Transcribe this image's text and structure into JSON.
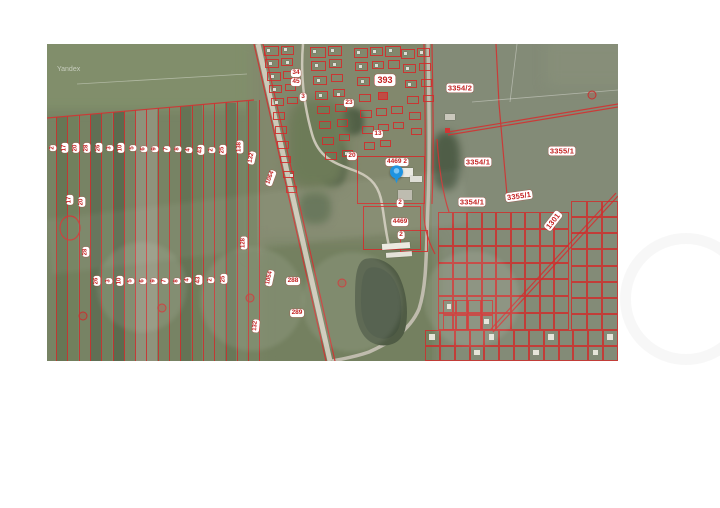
{
  "watermark": {
    "provider": "Yandex"
  },
  "map": {
    "x": 47,
    "y": 44,
    "w": 571,
    "h": 317,
    "base_color": "#717e5e",
    "accent_red": "#cf2b2b",
    "pin": {
      "x": 350,
      "y": 139,
      "color": "#1e93e0"
    },
    "strips": {
      "x0": 9,
      "spacing": 11.3,
      "count": 19,
      "top_left": 74,
      "top_right": 56,
      "bottom": 317
    },
    "strip_fills": [
      {
        "x": 9,
        "c": "#5d6d4c"
      },
      {
        "x": 20,
        "c": "#6a7a56"
      },
      {
        "x": 43,
        "c": "#55654a"
      },
      {
        "x": 54,
        "c": "#697957"
      },
      {
        "x": 66,
        "c": "#4f6044"
      },
      {
        "x": 88,
        "c": "#8e907a"
      },
      {
        "x": 99,
        "c": "#8f927c"
      },
      {
        "x": 133,
        "c": "#5a6a4c"
      },
      {
        "x": 144,
        "c": "#687854"
      },
      {
        "x": 178,
        "c": "#5f6f50"
      },
      {
        "x": 199,
        "c": "#6d7d5a"
      }
    ],
    "patches": [
      {
        "x": -10,
        "y": -12,
        "w": 245,
        "h": 78,
        "c": "#7c8a66",
        "blur": 5,
        "rad": 0
      },
      {
        "x": 205,
        "y": -6,
        "w": 190,
        "h": 215,
        "c": "#7d8368",
        "blur": 7,
        "rad": 0
      },
      {
        "x": 385,
        "y": -6,
        "w": 200,
        "h": 335,
        "c": "#7e8672",
        "blur": 0,
        "rad": 0
      },
      {
        "x": 500,
        "y": -4,
        "w": 85,
        "h": 45,
        "c": "#828a74",
        "blur": 6,
        "rad": 0
      },
      {
        "x": 215,
        "y": 196,
        "w": 175,
        "h": 130,
        "c": "#6e7b5a",
        "blur": 6,
        "rad": 0
      },
      {
        "x": 273,
        "y": 96,
        "w": 26,
        "h": 46,
        "c": "#41503c",
        "blur": 3,
        "rad": 40
      },
      {
        "x": 293,
        "y": 64,
        "w": 24,
        "h": 27,
        "c": "#49583f",
        "blur": 3,
        "rad": 40
      },
      {
        "x": 385,
        "y": 88,
        "w": 28,
        "h": 58,
        "c": "#475640",
        "blur": 4,
        "rad": 40
      },
      {
        "x": 252,
        "y": 148,
        "w": 32,
        "h": 32,
        "c": "#5b6b4d",
        "blur": 4,
        "rad": 40
      },
      {
        "x": 240,
        "y": 55,
        "w": 60,
        "h": 90,
        "c": "#677552",
        "blur": 6,
        "rad": 30
      }
    ],
    "labels": [
      {
        "t": "2",
        "x": 6,
        "y": 104,
        "r": -90
      },
      {
        "t": "17",
        "x": 18,
        "y": 104,
        "r": -90
      },
      {
        "t": "20",
        "x": 29,
        "y": 104,
        "r": -90
      },
      {
        "t": "28",
        "x": 40,
        "y": 104,
        "r": -90
      },
      {
        "t": "26",
        "x": 52,
        "y": 104,
        "r": -90
      },
      {
        "t": "3",
        "x": 63,
        "y": 104,
        "r": -90
      },
      {
        "t": "10",
        "x": 74,
        "y": 104,
        "r": -90
      },
      {
        "t": "5",
        "x": 86,
        "y": 104,
        "r": -90
      },
      {
        "t": "6",
        "x": 97,
        "y": 105,
        "r": -90
      },
      {
        "t": "9",
        "x": 108,
        "y": 105,
        "r": -90
      },
      {
        "t": "7",
        "x": 120,
        "y": 105,
        "r": -90
      },
      {
        "t": "8",
        "x": 131,
        "y": 105,
        "r": -90
      },
      {
        "t": "4",
        "x": 142,
        "y": 106,
        "r": -90
      },
      {
        "t": "43",
        "x": 154,
        "y": 106,
        "r": -90
      },
      {
        "t": "2",
        "x": 165,
        "y": 106,
        "r": -90
      },
      {
        "t": "25",
        "x": 176,
        "y": 106,
        "r": -90
      },
      {
        "t": "138",
        "x": 193,
        "y": 103,
        "r": -90
      },
      {
        "t": "132",
        "x": 205,
        "y": 114,
        "r": -78
      },
      {
        "t": "1064",
        "x": 224,
        "y": 134,
        "r": -70
      },
      {
        "t": "26",
        "x": 50,
        "y": 237,
        "r": -90
      },
      {
        "t": "3",
        "x": 62,
        "y": 237,
        "r": -90
      },
      {
        "t": "10",
        "x": 73,
        "y": 237,
        "r": -90
      },
      {
        "t": "5",
        "x": 84,
        "y": 237,
        "r": -90
      },
      {
        "t": "6",
        "x": 96,
        "y": 237,
        "r": -90
      },
      {
        "t": "9",
        "x": 107,
        "y": 237,
        "r": -90
      },
      {
        "t": "7",
        "x": 118,
        "y": 237,
        "r": -90
      },
      {
        "t": "8",
        "x": 130,
        "y": 237,
        "r": -90
      },
      {
        "t": "4",
        "x": 141,
        "y": 236,
        "r": -90
      },
      {
        "t": "43",
        "x": 152,
        "y": 236,
        "r": -90
      },
      {
        "t": "2",
        "x": 164,
        "y": 236,
        "r": -90
      },
      {
        "t": "25",
        "x": 177,
        "y": 235,
        "r": -90
      },
      {
        "t": "128",
        "x": 197,
        "y": 199,
        "r": -90
      },
      {
        "t": "1054",
        "x": 223,
        "y": 234,
        "r": -78
      },
      {
        "t": "132",
        "x": 209,
        "y": 282,
        "r": -85
      },
      {
        "t": "17",
        "x": 23,
        "y": 156,
        "r": -90
      },
      {
        "t": "20",
        "x": 35,
        "y": 158,
        "r": -90
      },
      {
        "t": "28",
        "x": 39,
        "y": 208,
        "r": -90
      },
      {
        "t": "34",
        "x": 249,
        "y": 29,
        "s": "m"
      },
      {
        "t": "45",
        "x": 249,
        "y": 38,
        "s": "m"
      },
      {
        "t": "3",
        "x": 256,
        "y": 53,
        "s": "m"
      },
      {
        "t": "23",
        "x": 302,
        "y": 59,
        "s": "m"
      },
      {
        "t": "393",
        "x": 338,
        "y": 36,
        "s": "xl"
      },
      {
        "t": "13",
        "x": 331,
        "y": 90,
        "s": "m"
      },
      {
        "t": "20",
        "x": 305,
        "y": 112,
        "s": "m"
      },
      {
        "t": "4469 2",
        "x": 350,
        "y": 118,
        "s": "m"
      },
      {
        "t": "2",
        "x": 353,
        "y": 159,
        "s": "m"
      },
      {
        "t": "4469",
        "x": 353,
        "y": 178,
        "s": "m"
      },
      {
        "t": "2",
        "x": 354,
        "y": 191,
        "s": "m"
      },
      {
        "t": "288",
        "x": 246,
        "y": 237,
        "s": "m"
      },
      {
        "t": "289",
        "x": 250,
        "y": 269,
        "s": "m"
      },
      {
        "t": "3354/2",
        "x": 413,
        "y": 44,
        "s": "l"
      },
      {
        "t": "3354/1",
        "x": 431,
        "y": 118,
        "s": "l"
      },
      {
        "t": "3354/1",
        "x": 425,
        "y": 158,
        "s": "l"
      },
      {
        "t": "3355/1",
        "x": 515,
        "y": 107,
        "s": "l"
      },
      {
        "t": "3355/1",
        "x": 472,
        "y": 152,
        "r": -8,
        "s": "l"
      },
      {
        "t": "1301",
        "x": 506,
        "y": 177,
        "r": -52,
        "s": "l"
      }
    ],
    "parcels": [
      [
        217,
        2,
        15,
        10
      ],
      [
        234,
        2,
        13,
        9
      ],
      [
        218,
        15,
        14,
        9
      ],
      [
        234,
        14,
        12,
        8
      ],
      [
        220,
        28,
        14,
        9
      ],
      [
        236,
        27,
        12,
        8
      ],
      [
        222,
        41,
        13,
        8
      ],
      [
        238,
        40,
        11,
        7
      ],
      [
        224,
        54,
        13,
        8
      ],
      [
        240,
        53,
        11,
        7
      ],
      [
        226,
        68,
        12,
        8
      ],
      [
        228,
        82,
        12,
        8
      ],
      [
        230,
        97,
        12,
        8
      ],
      [
        233,
        112,
        11,
        7
      ],
      [
        236,
        127,
        11,
        7
      ],
      [
        239,
        142,
        11,
        7
      ],
      [
        263,
        3,
        16,
        11
      ],
      [
        281,
        2,
        14,
        10
      ],
      [
        264,
        17,
        15,
        10
      ],
      [
        282,
        15,
        13,
        9
      ],
      [
        266,
        32,
        14,
        9
      ],
      [
        284,
        30,
        12,
        8
      ],
      [
        268,
        47,
        13,
        9
      ],
      [
        286,
        45,
        12,
        8
      ],
      [
        270,
        62,
        13,
        8
      ],
      [
        288,
        60,
        12,
        8
      ],
      [
        272,
        77,
        12,
        8
      ],
      [
        290,
        75,
        11,
        8
      ],
      [
        275,
        93,
        12,
        8
      ],
      [
        292,
        90,
        11,
        7
      ],
      [
        278,
        108,
        12,
        8
      ],
      [
        295,
        106,
        11,
        7
      ],
      [
        307,
        4,
        14,
        10
      ],
      [
        323,
        3,
        13,
        9
      ],
      [
        338,
        2,
        16,
        11
      ],
      [
        308,
        18,
        13,
        9
      ],
      [
        325,
        17,
        12,
        8
      ],
      [
        341,
        16,
        12,
        9
      ],
      [
        310,
        33,
        13,
        9
      ],
      [
        327,
        32,
        12,
        8
      ],
      [
        312,
        50,
        12,
        8
      ],
      [
        313,
        66,
        12,
        8
      ],
      [
        329,
        64,
        11,
        8
      ],
      [
        344,
        62,
        12,
        8
      ],
      [
        315,
        82,
        12,
        8
      ],
      [
        331,
        80,
        11,
        7
      ],
      [
        346,
        78,
        11,
        7
      ],
      [
        317,
        98,
        11,
        8
      ],
      [
        333,
        96,
        11,
        7
      ],
      [
        354,
        5,
        14,
        10
      ],
      [
        370,
        4,
        13,
        9
      ],
      [
        356,
        20,
        13,
        9
      ],
      [
        372,
        19,
        12,
        8
      ],
      [
        358,
        36,
        12,
        8
      ],
      [
        374,
        35,
        11,
        8
      ],
      [
        360,
        52,
        12,
        8
      ],
      [
        376,
        51,
        11,
        7
      ],
      [
        362,
        68,
        12,
        8
      ],
      [
        364,
        84,
        11,
        7
      ],
      [
        310,
        112,
        68,
        48
      ],
      [
        316,
        162,
        58,
        44
      ],
      [
        353,
        186,
        28,
        22
      ],
      [
        331,
        48,
        10,
        8,
        1
      ]
    ],
    "houses": [
      [
        220,
        5
      ],
      [
        237,
        4
      ],
      [
        222,
        18
      ],
      [
        239,
        17
      ],
      [
        224,
        31
      ],
      [
        226,
        44
      ],
      [
        228,
        57
      ],
      [
        266,
        6
      ],
      [
        284,
        5
      ],
      [
        268,
        20
      ],
      [
        286,
        19
      ],
      [
        270,
        35
      ],
      [
        272,
        50
      ],
      [
        290,
        49
      ],
      [
        310,
        7
      ],
      [
        326,
        6
      ],
      [
        342,
        5
      ],
      [
        312,
        21
      ],
      [
        328,
        20
      ],
      [
        314,
        36
      ],
      [
        357,
        8
      ],
      [
        373,
        7
      ],
      [
        359,
        23
      ],
      [
        361,
        39
      ],
      [
        298,
        108
      ],
      [
        243,
        130
      ]
    ],
    "buildings": [
      [
        346,
        124,
        20,
        9,
        0,
        "#e9e9e3"
      ],
      [
        363,
        132,
        12,
        6,
        0,
        "#dcdcd4"
      ],
      [
        351,
        146,
        14,
        10,
        0,
        "#b8b6aa"
      ],
      [
        335,
        199,
        28,
        6,
        -4,
        "#eceae2"
      ],
      [
        339,
        208,
        26,
        5,
        -4,
        "#e4e2d8"
      ],
      [
        398,
        70,
        10,
        6,
        0,
        "#c9c7bb"
      ]
    ],
    "grids": [
      {
        "x": 391,
        "y": 168,
        "w": 131,
        "h": 118,
        "cols": 9,
        "rows": 7,
        "houses": false
      },
      {
        "x": 524,
        "y": 157,
        "w": 47,
        "h": 129,
        "cols": 3,
        "rows": 8,
        "houses": false
      },
      {
        "x": 378,
        "y": 286,
        "w": 193,
        "h": 31,
        "cols": 13,
        "rows": 2,
        "houses": true
      },
      {
        "x": 396,
        "y": 256,
        "w": 50,
        "h": 30,
        "cols": 4,
        "rows": 2,
        "houses": true
      }
    ],
    "circles": [
      [
        36,
        272
      ],
      [
        115,
        264
      ],
      [
        203,
        254
      ],
      [
        295,
        239
      ],
      [
        545,
        51
      ]
    ]
  }
}
